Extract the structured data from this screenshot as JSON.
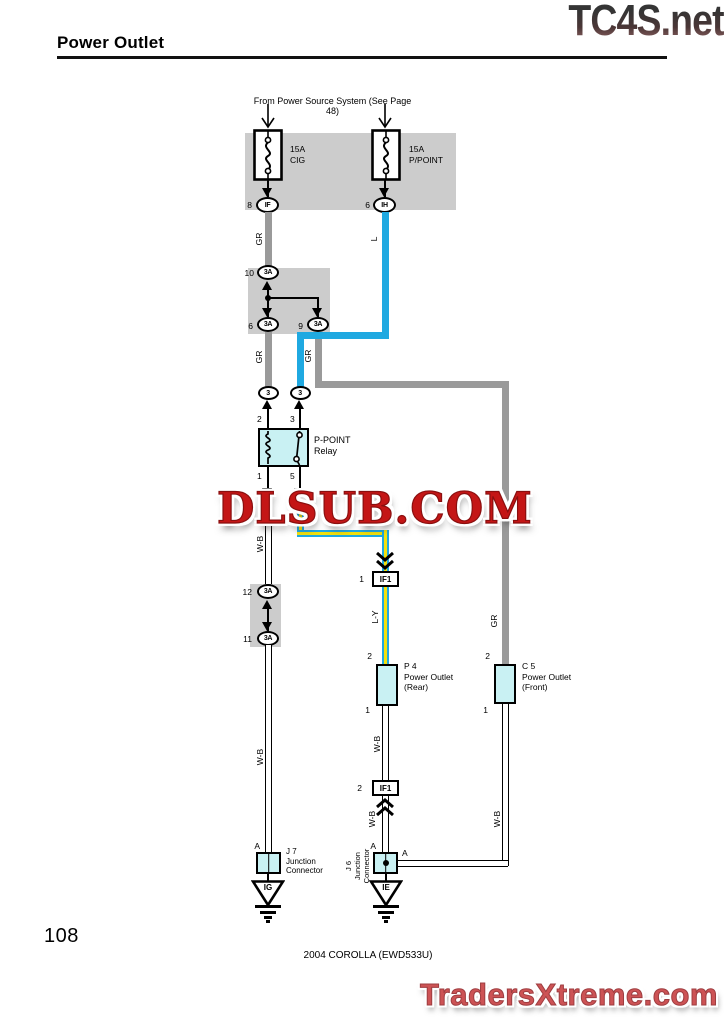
{
  "colors": {
    "wire_gray": "#9a9a9a",
    "wire_blue": "#1fa9e1",
    "wire_yellow": "#f2e10e",
    "component_fill": "#c9f1f3",
    "block_gray": "#cccccc",
    "watermark_red": "#c41616",
    "brand_red": "#cd5355"
  },
  "header": {
    "title": "Power Outlet",
    "logo": "TC4S.net"
  },
  "watermark": {
    "center": "DLSUB.COM"
  },
  "footer": {
    "page_number": "108",
    "doc_code": "2004 COROLLA (EWD533U)",
    "brand": "TradersXtreme.com"
  },
  "diagram": {
    "source_note": "From Power Source System (See Page 48)",
    "wire_labels": {
      "gr": "GR",
      "l": "L",
      "wb": "W-B",
      "ly": "L-Y"
    },
    "fuse_cig": {
      "rating": "15A",
      "name": "CIG",
      "pin": "8",
      "conn": "IF"
    },
    "fuse_ppoint": {
      "rating": "15A",
      "name": "P/POINT",
      "pin": "6",
      "conn": "IH"
    },
    "jb_top": {
      "pin_in": "10",
      "pin_out_left": "6",
      "pin_out_right": "9",
      "code": "3A"
    },
    "conn3": {
      "left": "3",
      "right": "3"
    },
    "relay": {
      "name_line1": "P-POINT",
      "name_line2": "Relay",
      "pin_tl": "2",
      "pin_tr": "3",
      "pin_bl": "1",
      "pin_br": "5"
    },
    "jb_mid": {
      "pin_in": "12",
      "pin_out": "11",
      "code": "3A"
    },
    "if1_upper": {
      "pin": "1",
      "label": "IF1"
    },
    "if1_lower": {
      "pin": "2",
      "label": "IF1"
    },
    "p4": {
      "code": "P 4",
      "name_line1": "Power Outlet",
      "name_line2": "(Rear)",
      "pin_top": "2",
      "pin_bottom": "1"
    },
    "c5": {
      "code": "C 5",
      "name_line1": "Power Outlet",
      "name_line2": "(Front)",
      "pin_top": "2",
      "pin_bottom": "1"
    },
    "j7": {
      "code": "J 7",
      "name_line1": "Junction",
      "name_line2": "Connector",
      "pin": "A"
    },
    "j6": {
      "code": "J 6",
      "name_line1": "Junction",
      "name_line2": "Connector",
      "pin_top": "A",
      "pin_right": "A"
    },
    "grounds": {
      "ig": "IG",
      "ie": "IE"
    }
  }
}
